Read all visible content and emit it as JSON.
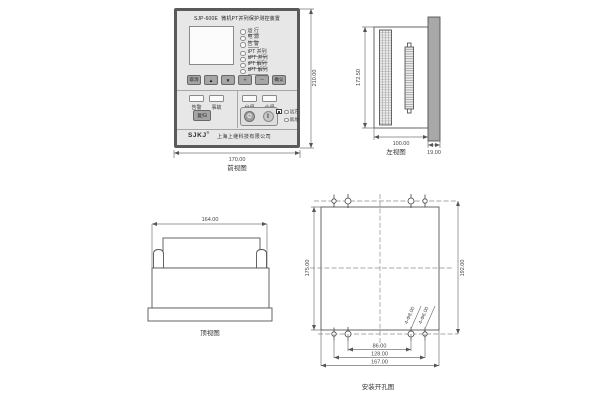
{
  "views": {
    "front": {
      "caption": "前视图",
      "dims": {
        "width": "170.00",
        "height": "210.00"
      }
    },
    "left": {
      "caption": "左视图",
      "dims": {
        "depth": "100.00",
        "panel_thickness": "19.00",
        "height": "172.50"
      }
    },
    "top": {
      "caption": "顶视图",
      "dims": {
        "width": "164.00"
      }
    },
    "mount": {
      "caption": "安装开孔图",
      "dims": {
        "cutout_height": "175.00",
        "hole_row_span": "192.00",
        "inner_hole_span": "86.00",
        "outer_hole_span": "128.00",
        "cutout_width": "167.00"
      },
      "hole_labels": [
        "4-Φ8.00",
        "4-Φ6.00"
      ]
    }
  },
  "panel": {
    "model": "SJP-600E",
    "title": "微机PT并列保护测控装置",
    "status_leds": [
      "运 行",
      "电 源",
      "告 警"
    ],
    "pt_leds": [
      "ⅠPT 并列",
      "ⅡPT 并列",
      "ⅠPT 解列",
      "ⅡPT 解列"
    ],
    "keys": [
      "取消",
      "▲",
      "▼",
      "＋",
      "－",
      "确认"
    ],
    "signal_windows": [
      "告警",
      "事故"
    ],
    "reset_key": "复归",
    "switch_windows": [
      "分闸",
      "合闸"
    ],
    "open_key": "O",
    "close_key": "I",
    "side_leds": [
      "远方",
      "就地"
    ],
    "brand": "SJKJ",
    "brand_mark": "®",
    "company": "上海上继科技有限公司"
  },
  "colors": {
    "panel_frame": "#5a5a5a",
    "panel_face": "#e7e7e7",
    "bezel_fill": "#a8a8a8",
    "line": "#555555"
  }
}
